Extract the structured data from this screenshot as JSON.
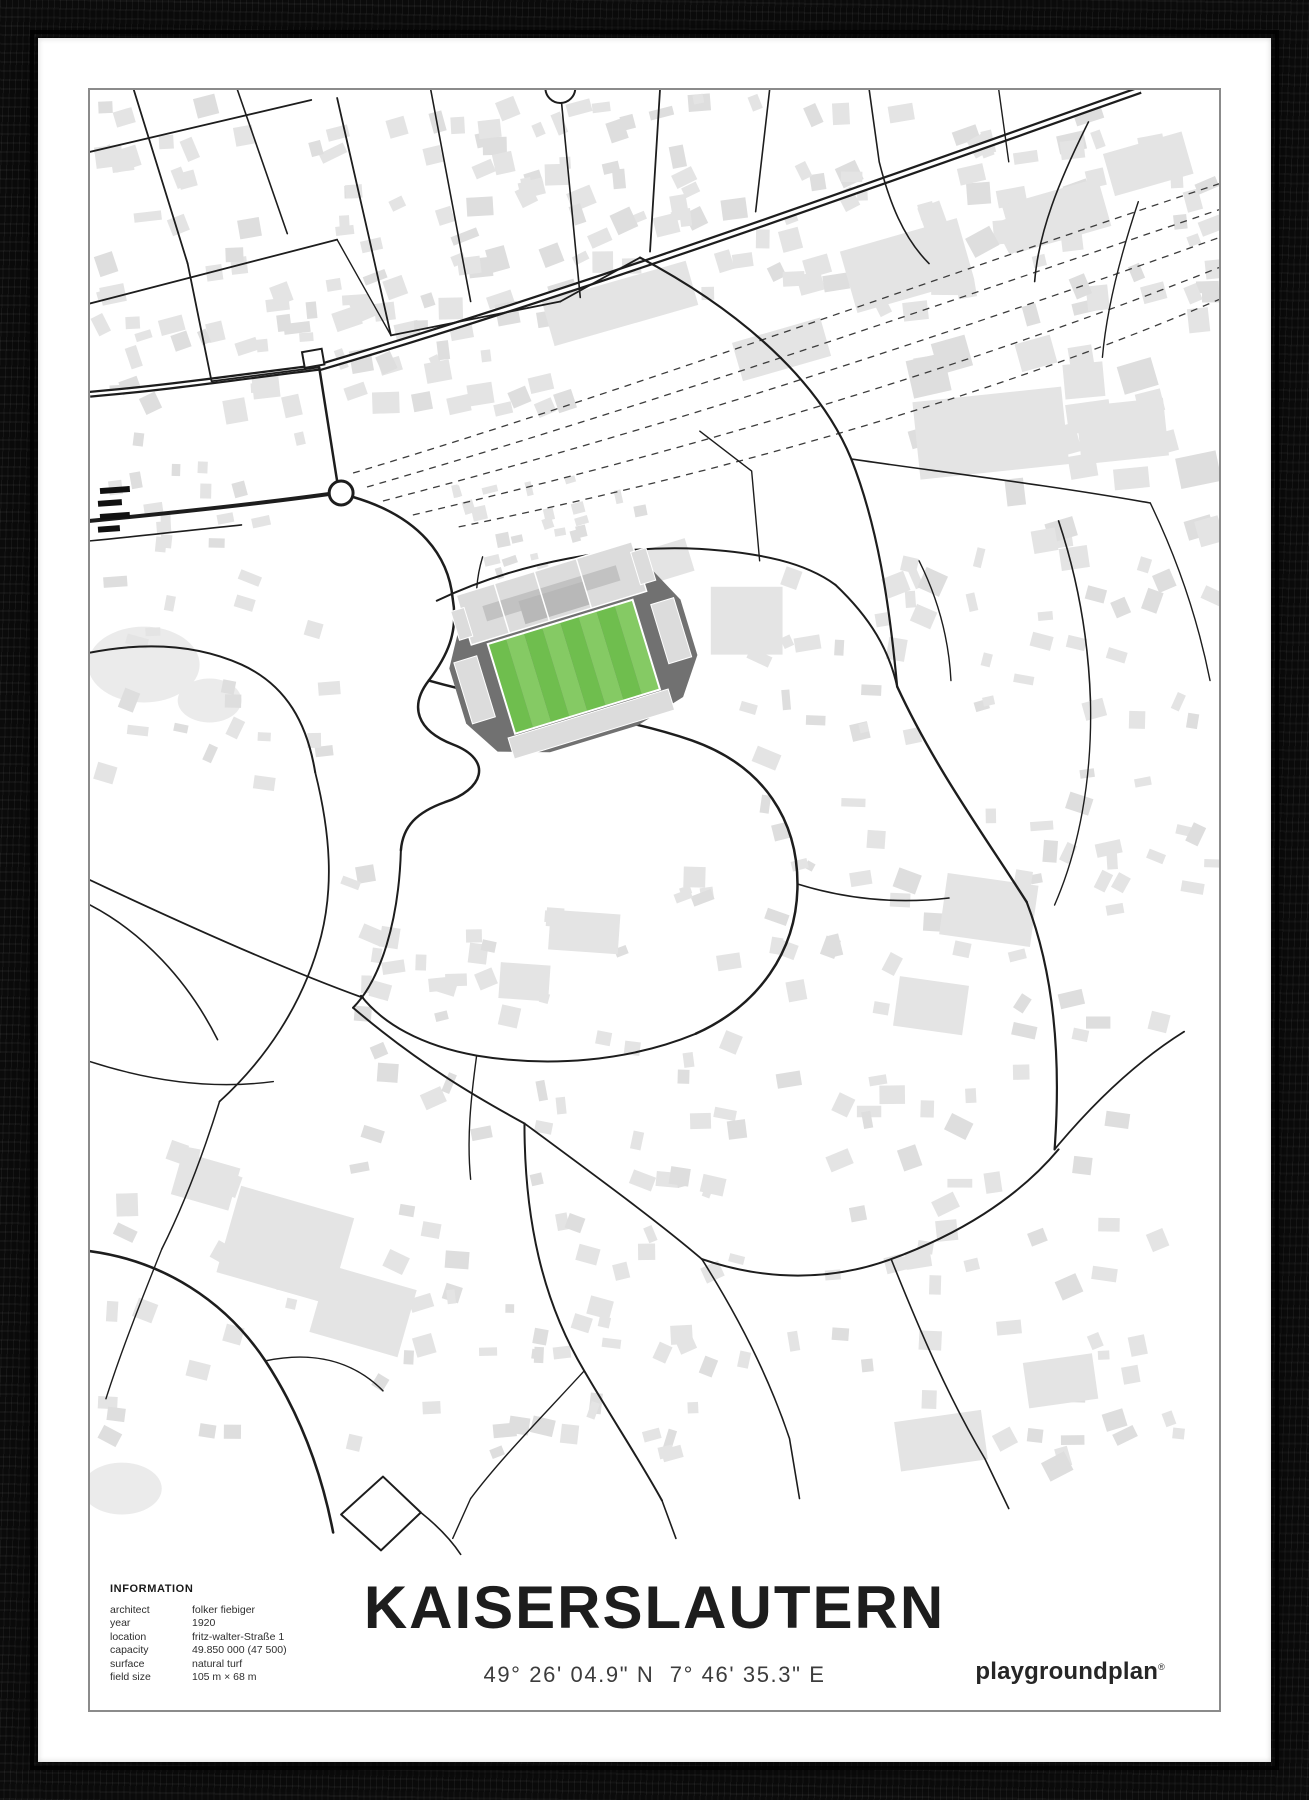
{
  "title": "KAISERSLAUTERN",
  "coordinates": "49° 26' 04.9\" N  7° 46' 35.3\" E",
  "brand": {
    "name": "playgroundplan",
    "mark": "®"
  },
  "info": {
    "heading": "INFORMATION",
    "rows": [
      {
        "label": "architect",
        "value": "folker fiebiger"
      },
      {
        "label": "year",
        "value": "1920"
      },
      {
        "label": "location",
        "value": "fritz-walter-Straße 1"
      },
      {
        "label": "capacity",
        "value": "49.850 000 (47 500)"
      },
      {
        "label": "surface",
        "value": "natural turf"
      },
      {
        "label": "field size",
        "value": "105 m × 68 m"
      }
    ]
  },
  "colors": {
    "frame": "#0b0b0b",
    "mat": "#ffffff",
    "map_border": "#8b8b8b",
    "road": "#1d1d1d",
    "bldg": "#e4e4e4",
    "bldg2": "#dedede",
    "rail": "#3c3c3c",
    "stand_light": "#dcdcdc",
    "stand_mid": "#c2c2c2",
    "stand_dark": "#717171",
    "pitch_a": "#6fbe4e",
    "pitch_b": "#85ca64",
    "text_dark": "#1d1d1d",
    "text_mid": "#3c3c3c"
  }
}
